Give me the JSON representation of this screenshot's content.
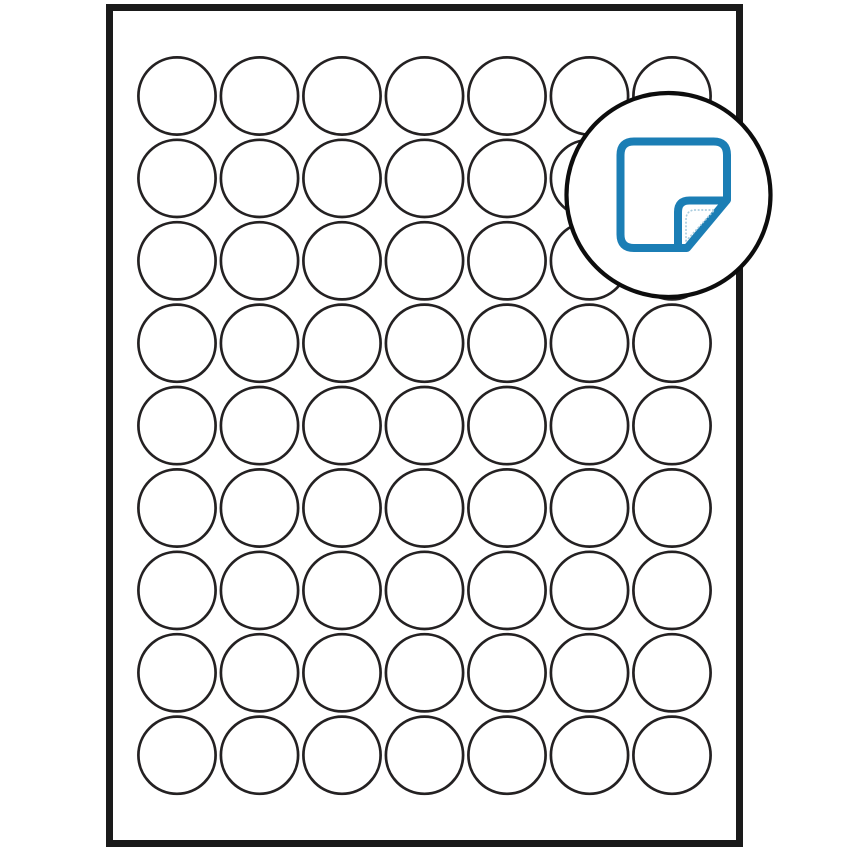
{
  "diagram": {
    "kind": "blank-label-sheet-template",
    "description": "Sheet of blank circular labels with magnified peel-corner label icon",
    "canvas": {
      "width": 850,
      "height": 850,
      "background": "#ffffff"
    }
  },
  "colors": {
    "background": "#ffffff",
    "sheet_fill": "#ffffff",
    "sheet_border": "#1a1a1a",
    "circle_stroke": "#242122",
    "circle_fill": "#ffffff",
    "bubble_fill": "#ffffff",
    "bubble_stroke": "#0d0d0d",
    "icon_blue": "#1b7eb5",
    "icon_dotted": "#a8cbdd"
  },
  "sheet": {
    "x": 106,
    "y": 4,
    "width": 637,
    "height": 843,
    "border_width": 7
  },
  "label_grid": {
    "shape": "circle",
    "columns": 7,
    "rows": 9,
    "total_labels": 63,
    "first_center_x": 177,
    "first_center_y": 96,
    "col_spacing": 82.5,
    "row_spacing": 82.4,
    "circle_radius": 38.6,
    "stroke_width": 2.7
  },
  "zoom_bubble": {
    "center_x": 668.5,
    "center_y": 195,
    "radius": 102,
    "stroke_width": 4.2
  },
  "peel_icon": {
    "name": "label-peel-icon",
    "stroke_width": 8,
    "dotted_stroke_width": 1.7,
    "body_path": "M 677 248 H 634 Q 620.5 248 620.5 234.5 V 155 Q 620.5 141.5 634 141.5 H 713.5 Q 727 141.5 727 155 V 199",
    "fold_diagonal_path": "M 727 200 L 687 248 L 678 248",
    "fold_flap_path": "M 678 248 V 212 Q 678 200.5 689.5 200.5 H 723",
    "dotted_crease_path": "M 686 241 V 220 Q 686 210 695.5 210 H 714.5 L 686 241"
  }
}
